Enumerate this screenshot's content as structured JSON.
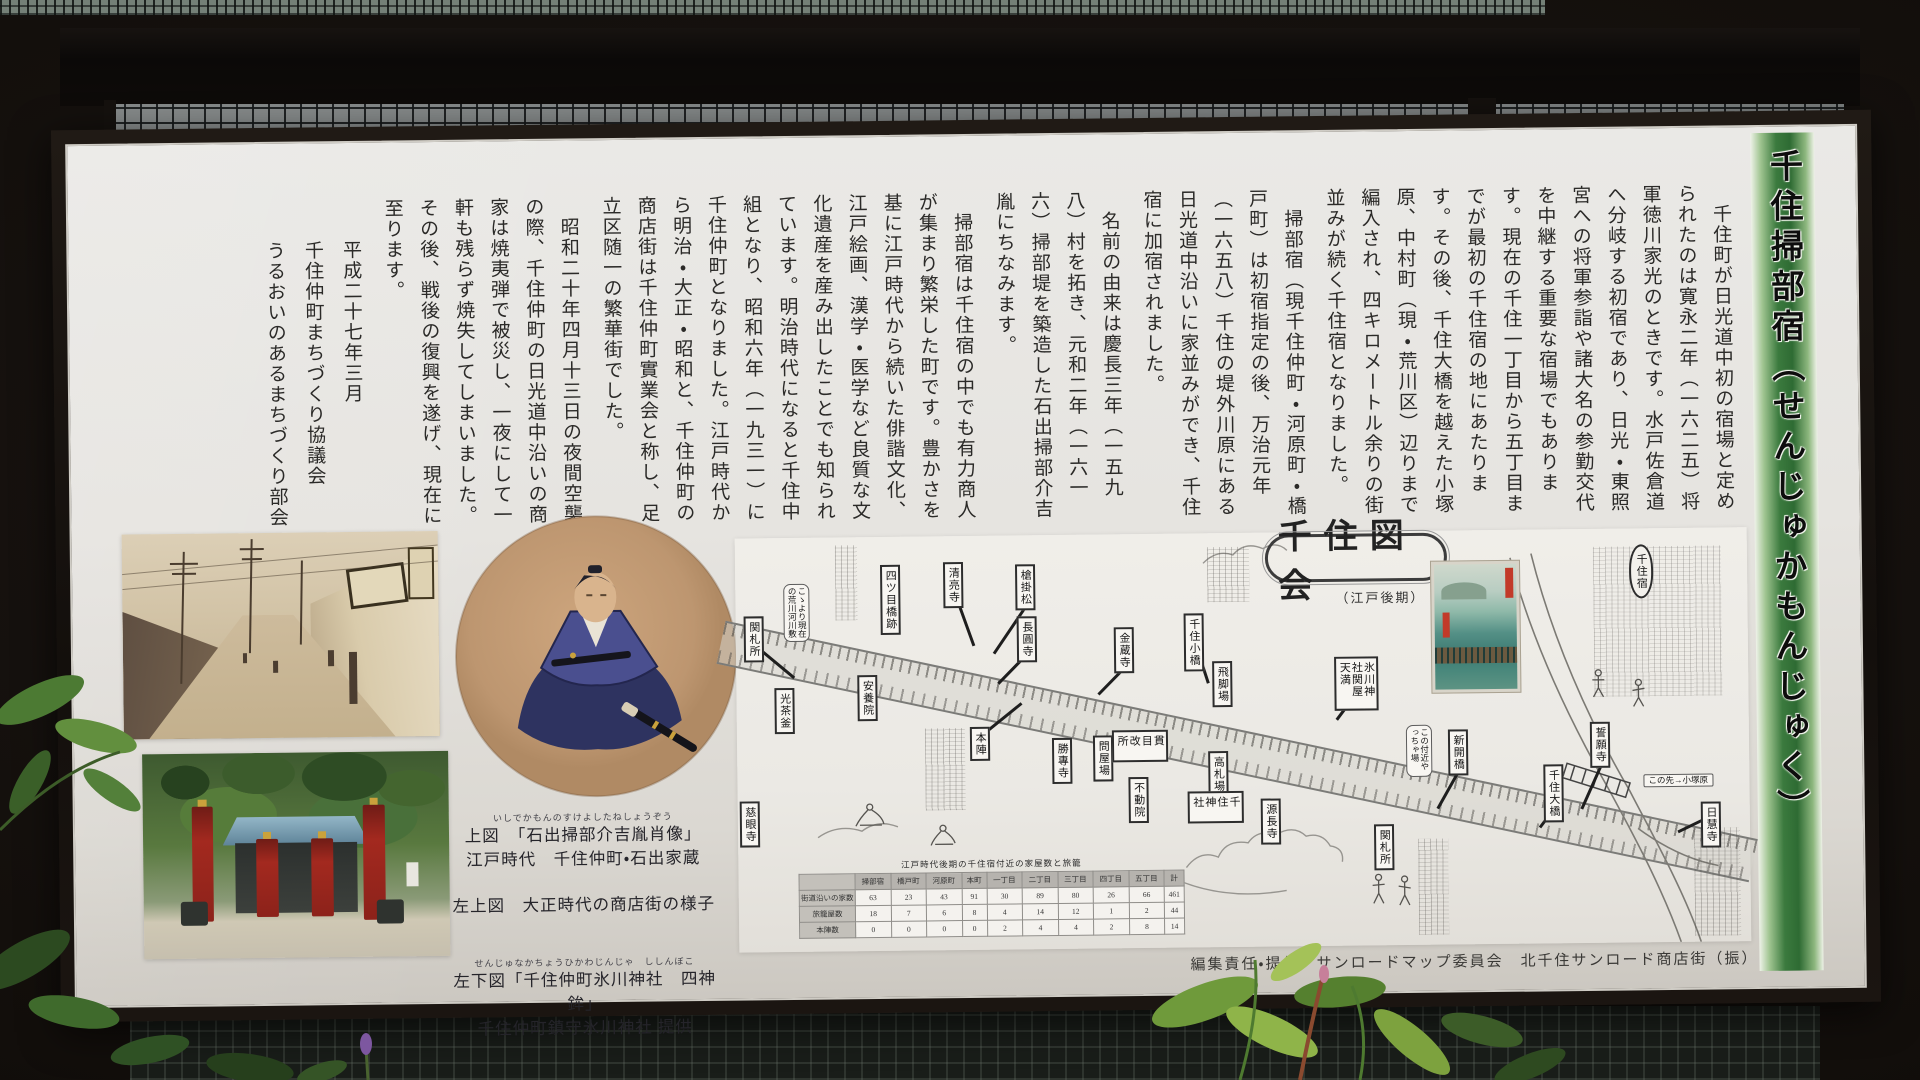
{
  "board": {
    "title_strip": "千住掃部宿（せんじゅかもんじゅく）",
    "paragraphs": [
      "　千住町が日光道中初の宿場と定められたのは寛永二年（一六二五）将軍徳川家光のときです。水戸佐倉道へ分岐する初宿であり、日光・東照宮への将軍参詣や諸大名の参勤交代を中継する重要な宿場でもあります。現在の千住一丁目から五丁目までが最初の千住宿の地にあたります。その後、千住大橋を越えた小塚原、中村町（現・荒川区）辺りまで編入され、四キロメートル余りの街並みが続く千住宿となりました。",
      "　掃部宿（現千住仲町・河原町・橋戸町）は初宿指定の後、万治元年（一六五八）千住の堤外川原にある日光道中沿いに家並みができ、千住宿に加宿されました。",
      "　名前の由来は慶長三年（一五九八）村を拓き、元和二年（一六一六）掃部堤を築造した石出掃部介吉胤にちなみます。",
      "　掃部宿は千住宿の中でも有力商人が集まり繁栄した町です。豊かさを基に江戸時代から続いた俳諧文化、江戸絵画、漢学・医学など良質な文化遺産を産み出したことでも知られています。明治時代になると千住中組となり、昭和六年（一九三一）に千住仲町となりました。江戸時代から明治・大正・昭和と、千住仲町の商店街は千住仲町實業会と称し、足立区随一の繁華街でした。",
      "　昭和二十年四月十三日の夜間空襲の際、千住仲町の日光道中沿いの商家は焼夷弾で被災し、一夜にして一軒も残らず焼失してしまいました。その後、戦後の復興を遂げ、現在に至ります。"
    ],
    "signature_lines": [
      "　　平成二十七年三月",
      "　　千住仲町まちづくり協議会",
      "　　うるおいのあるまちづくり部会"
    ],
    "captions": {
      "ruby_top": "いしでかもんのすけよしたねしょうぞう",
      "top_fig": "上図　「石出掃部介吉胤肖像」",
      "top_fig2": "江戸時代　千住仲町・石出家蔵",
      "left_top_fig": "左上図　大正時代の商店街の様子",
      "ruby_bottom": "せんじゅなかちょうひかわじんじゃ　ししんぼこ",
      "left_bottom_fig": "左下図「千住仲町氷川神社　四神鉾」",
      "left_bottom_fig2": "千住仲町鎮守氷川神社 提供"
    },
    "credit": "編集責任・提供　サンロードマップ委員会　北千住サンロード商店街（振）"
  },
  "map": {
    "title": "千住図会",
    "subtitle": "（江戸後期）",
    "labels": [
      {
        "text": "関札所",
        "x": 8,
        "y": 78,
        "kind": "box"
      },
      {
        "text": "光茶釜",
        "x": 38,
        "y": 150,
        "kind": "box"
      },
      {
        "text": "安養院",
        "x": 121,
        "y": 138,
        "kind": "box"
      },
      {
        "text": "四ツ目橋跡",
        "x": 145,
        "y": 28,
        "kind": "box"
      },
      {
        "text": "清亮寺",
        "x": 208,
        "y": 26,
        "kind": "box"
      },
      {
        "text": "槍掛松",
        "x": 280,
        "y": 29,
        "kind": "box"
      },
      {
        "text": "長圓寺",
        "x": 281,
        "y": 81,
        "kind": "box"
      },
      {
        "text": "金蔵寺",
        "x": 378,
        "y": 93,
        "kind": "box"
      },
      {
        "text": "千住小橋",
        "x": 448,
        "y": 80,
        "kind": "box"
      },
      {
        "text": "飛脚場",
        "x": 476,
        "y": 128,
        "kind": "box"
      },
      {
        "text": "氷川神社関屋天満",
        "x": 598,
        "y": 125,
        "kind": "box",
        "h": 54
      },
      {
        "text": "本陣",
        "x": 233,
        "y": 191,
        "kind": "box"
      },
      {
        "text": "勝專寺",
        "x": 315,
        "y": 203,
        "kind": "box"
      },
      {
        "text": "問屋場",
        "x": 356,
        "y": 201,
        "kind": "box"
      },
      {
        "text": "貫目改所",
        "x": 375,
        "y": 196,
        "kind": "box",
        "h": 32
      },
      {
        "text": "不動院",
        "x": 391,
        "y": 243,
        "kind": "box"
      },
      {
        "text": "慈眼寺",
        "x": 2,
        "y": 263,
        "kind": "box"
      },
      {
        "text": "高札場",
        "x": 471,
        "y": 218,
        "kind": "box"
      },
      {
        "text": "千住神社",
        "x": 450,
        "y": 258,
        "kind": "box",
        "h": 32
      },
      {
        "text": "源長寺",
        "x": 523,
        "y": 266,
        "kind": "box"
      },
      {
        "text": "関札所",
        "x": 636,
        "y": 293,
        "kind": "box"
      },
      {
        "text": "新開橋",
        "x": 711,
        "y": 199,
        "kind": "box"
      },
      {
        "text": "千住大橋",
        "x": 806,
        "y": 235,
        "kind": "box"
      },
      {
        "text": "誓願寺",
        "x": 853,
        "y": 193,
        "kind": "box"
      },
      {
        "text": "日慧寺",
        "x": 963,
        "y": 274,
        "kind": "box"
      },
      {
        "text": "千住宿",
        "x": 894,
        "y": 16,
        "kind": "oval"
      },
      {
        "text": "こゝより現在の荒川河川敷",
        "x": 48,
        "y": 46,
        "kind": "note",
        "h": 58
      },
      {
        "text": "この付近やっちゃ場",
        "x": 669,
        "y": 194,
        "kind": "note",
        "h": 52
      },
      {
        "text": "この先→小塚原",
        "x": 906,
        "y": 246,
        "kind": "noteh"
      }
    ],
    "table": {
      "title": "江戸時代後期の千住宿付近の家屋数と旅籠",
      "headers": [
        "",
        "掃部宿",
        "橋戸町",
        "河原町",
        "本町",
        "一丁目",
        "二丁目",
        "三丁目",
        "四丁目",
        "五丁目",
        "計"
      ],
      "rows": [
        {
          "label": "街道沿いの家数",
          "values": [
            "63",
            "23",
            "43",
            "91",
            "30",
            "89",
            "80",
            "26",
            "66",
            "461"
          ]
        },
        {
          "label": "旅籠屋数",
          "values": [
            "18",
            "7",
            "6",
            "8",
            "4",
            "14",
            "12",
            "1",
            "2",
            "44"
          ]
        },
        {
          "label": "本陣数",
          "values": [
            "0",
            "0",
            "0",
            "0",
            "2",
            "4",
            "4",
            "2",
            "8",
            "14"
          ]
        }
      ]
    }
  }
}
